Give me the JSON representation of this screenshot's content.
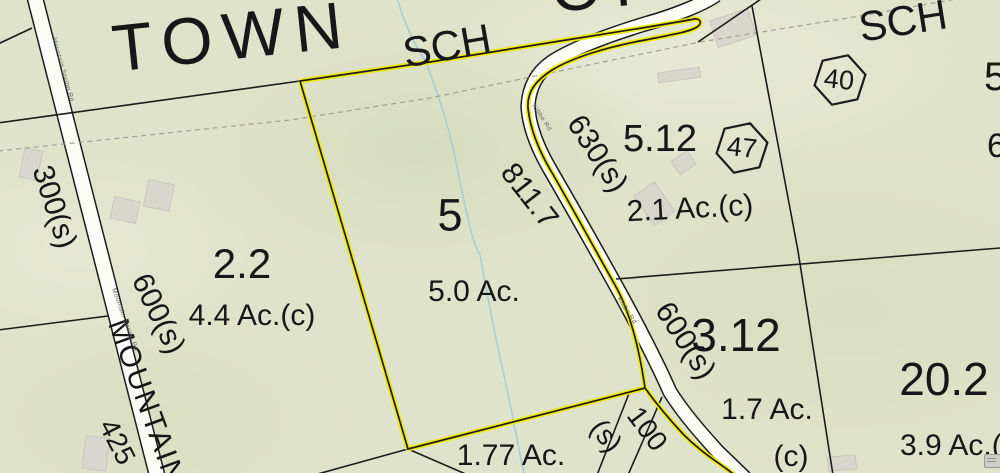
{
  "map": {
    "districts": {
      "town": "TOWN",
      "town_partial": "OF",
      "sch_west": "SCH",
      "sch_east": "SCH"
    },
    "road_names": {
      "mountain_big": "MOUNTAIN",
      "mountain_small_1": "Mountain Spring Rd",
      "mountain_small_2": "Mountain Spring Rd",
      "kibbe_small_1": "Kibbe Rd",
      "kibbe_small_2": "Kibbe Rd"
    },
    "parcels": {
      "p2_2": {
        "id": "2.2",
        "area": "4.4 Ac.(c)"
      },
      "p5": {
        "id": "5",
        "area": "5.0 Ac."
      },
      "p5_12": {
        "id": "5.12",
        "area": "2.1 Ac.(c)"
      },
      "p3_12": {
        "id": "3.12",
        "area": "1.7 Ac.",
        "area_suffix": "(c)"
      },
      "p20_2": {
        "id": "20.2",
        "area": "3.9 Ac.(c)"
      },
      "p1_77": {
        "area": "1.77 Ac."
      },
      "edge_partial_top": "5",
      "edge_partial_mid": "6"
    },
    "dimensions": {
      "left_300": "300(s)",
      "left_600": "600(s)",
      "left_425": "425",
      "center_811": "811.7",
      "center_630": "630(s)",
      "right_600": "600(s)",
      "bottom_100": "100",
      "bottom_100_s": "(s)"
    },
    "lot_markers": {
      "hex_40": "40",
      "hex_47": "47"
    },
    "colors": {
      "background": "#e0e3cb",
      "boundary_yellow": "#f1e90a",
      "parcel_line": "#1c1c1c",
      "road_fill": "#fcfcf6",
      "stream_blue": "#a9cdd4",
      "building_gray": "#d9d7cd",
      "dashed_gray": "#a0a096"
    }
  }
}
